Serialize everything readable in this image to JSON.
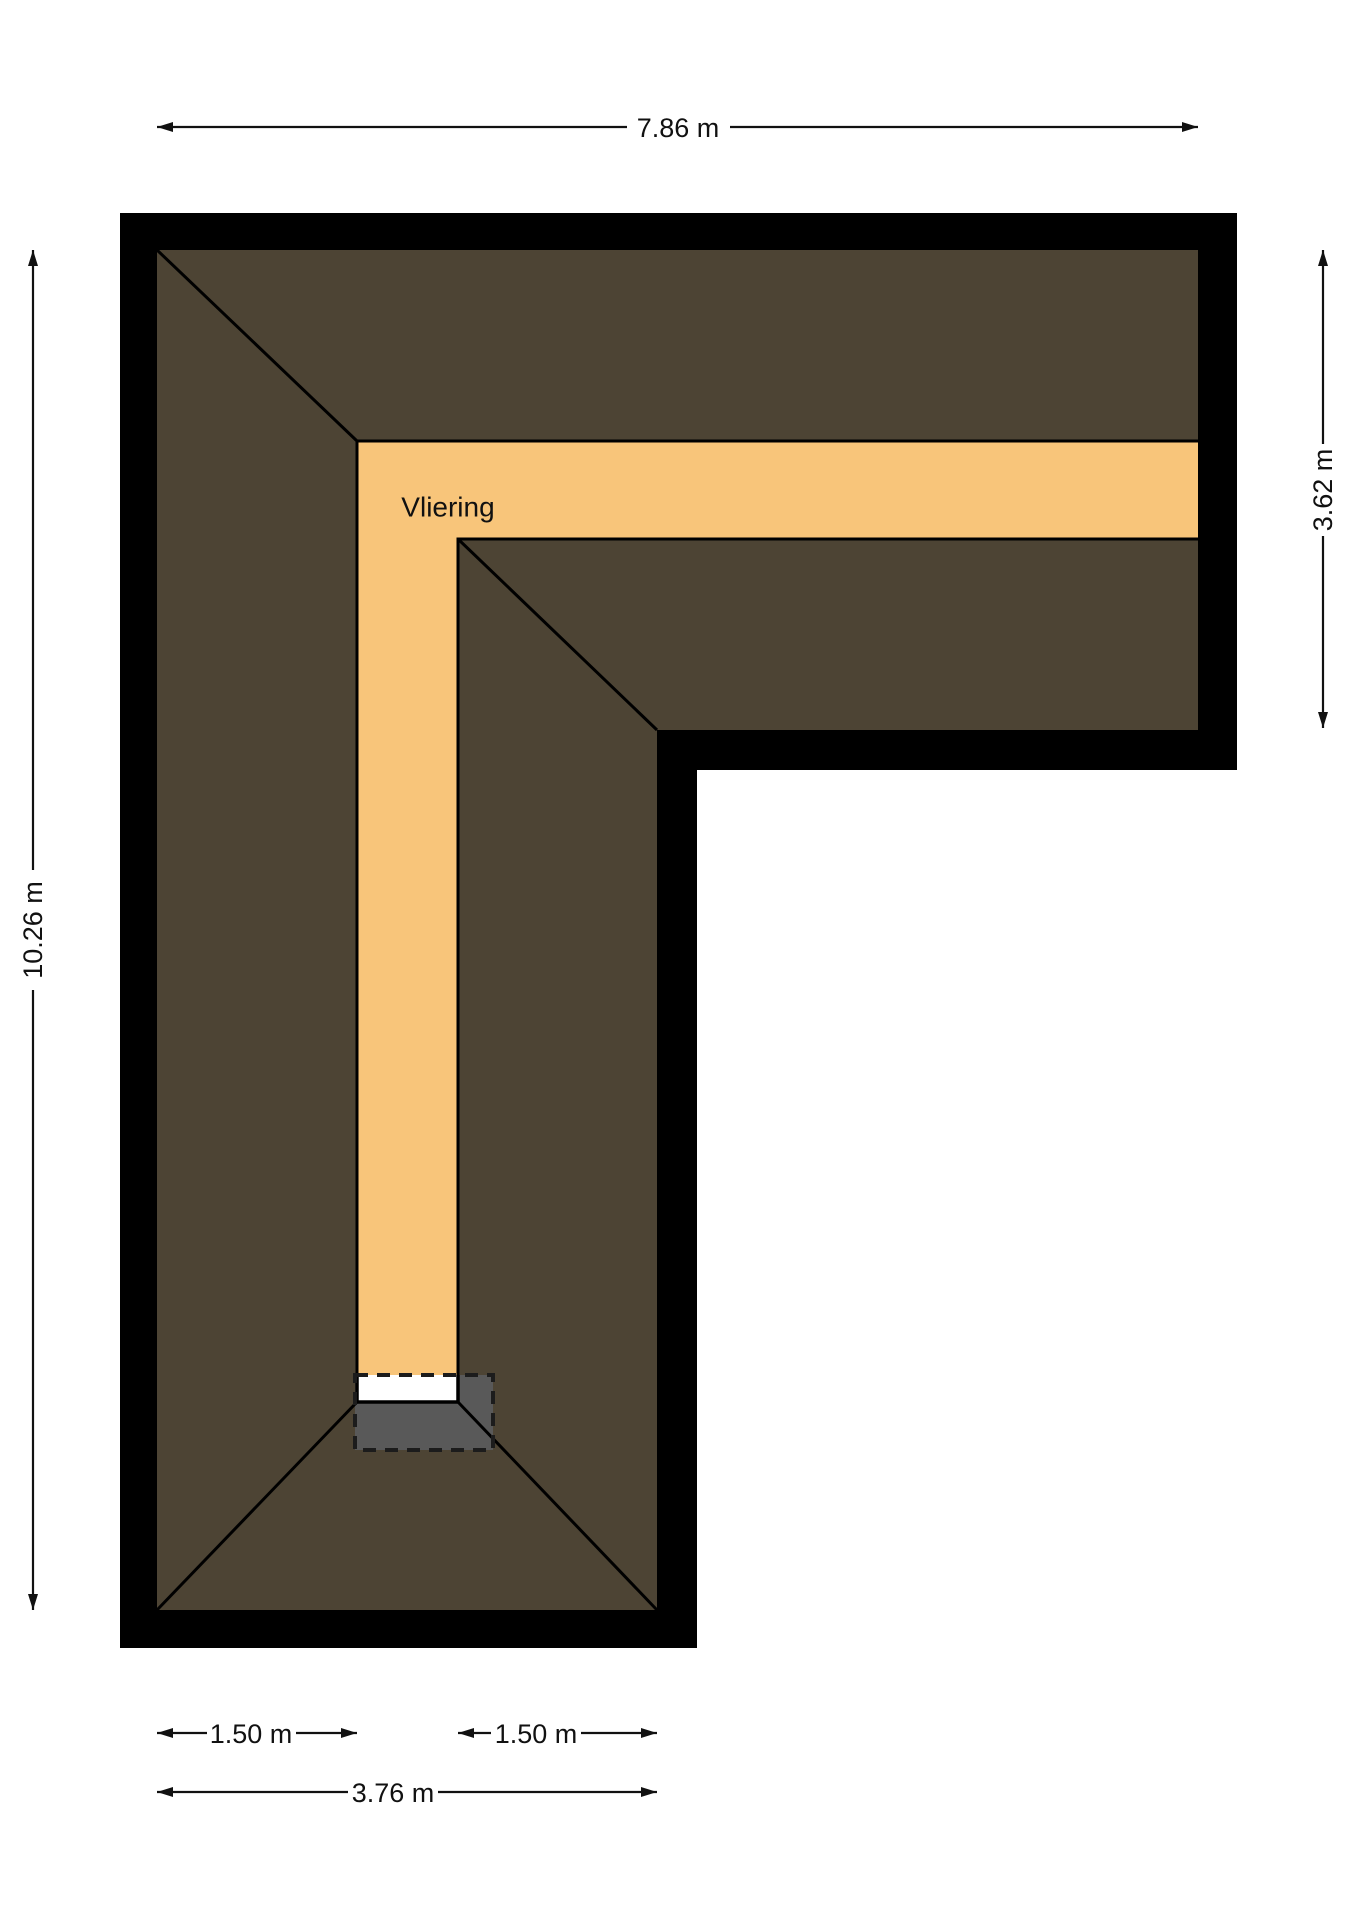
{
  "room": {
    "label": "Vliering"
  },
  "dimensions": {
    "top_width": "7.86 m",
    "left_height": "10.26 m",
    "right_wing_height": "3.62 m",
    "bottom_left_segment": "1.50 m",
    "bottom_right_segment": "1.50 m",
    "bottom_total": "3.76 m"
  },
  "colors": {
    "wall": "#000000",
    "roof": "#4d4434",
    "corridor": "#f8c57a",
    "stairwell": "#595959",
    "landing": "#ffffff",
    "background": "#ffffff"
  }
}
